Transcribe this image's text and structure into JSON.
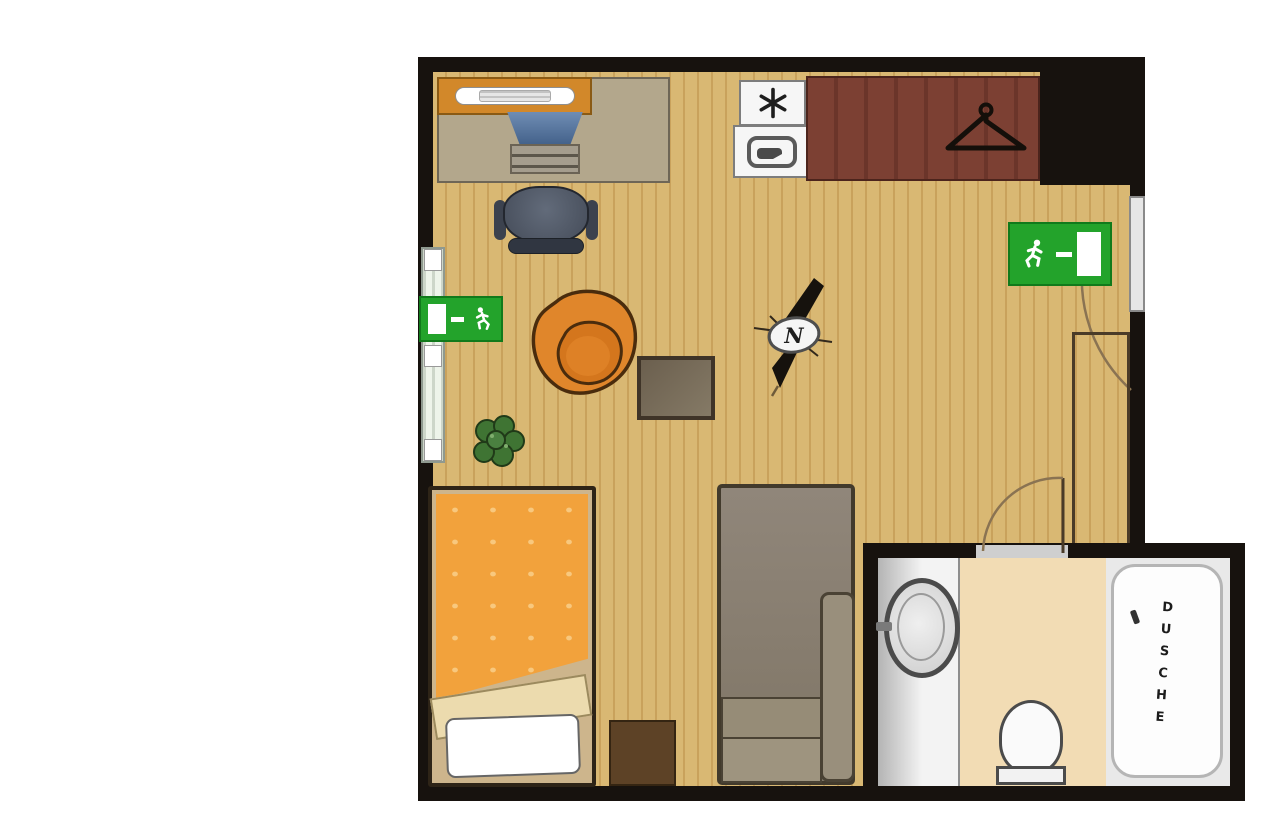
{
  "labels": {
    "shower": "DUSCHE",
    "compass_north": "N"
  },
  "colors": {
    "wall": "#17120e",
    "floor": "#d9b873",
    "floor_stripe": "#c9a25c",
    "exit_green": "#23a32b",
    "wardrobe": "#7c4033",
    "desk_shelf": "#d2882a",
    "desk_top": "#b3a78c",
    "armchair_orange": "#e0862b",
    "armchair_seat": "#d4761d",
    "bed_duvet": "#f2a23c",
    "blanket_cream": "#ecdbae",
    "nightstand_brown": "#5d4226",
    "sofa_taupe": "#8d8372",
    "bathroom_floor": "#f2dcb4",
    "plant_green": "#3f7433",
    "door_arc": "#8a7352"
  },
  "icons": {
    "exit_left": "running-man-exit-left",
    "exit_right": "running-man-exit-right",
    "wardrobe": "clothes-hanger",
    "freezer": "snowflake-asterisk",
    "cooktop": "pan",
    "compass": "north-needle"
  }
}
